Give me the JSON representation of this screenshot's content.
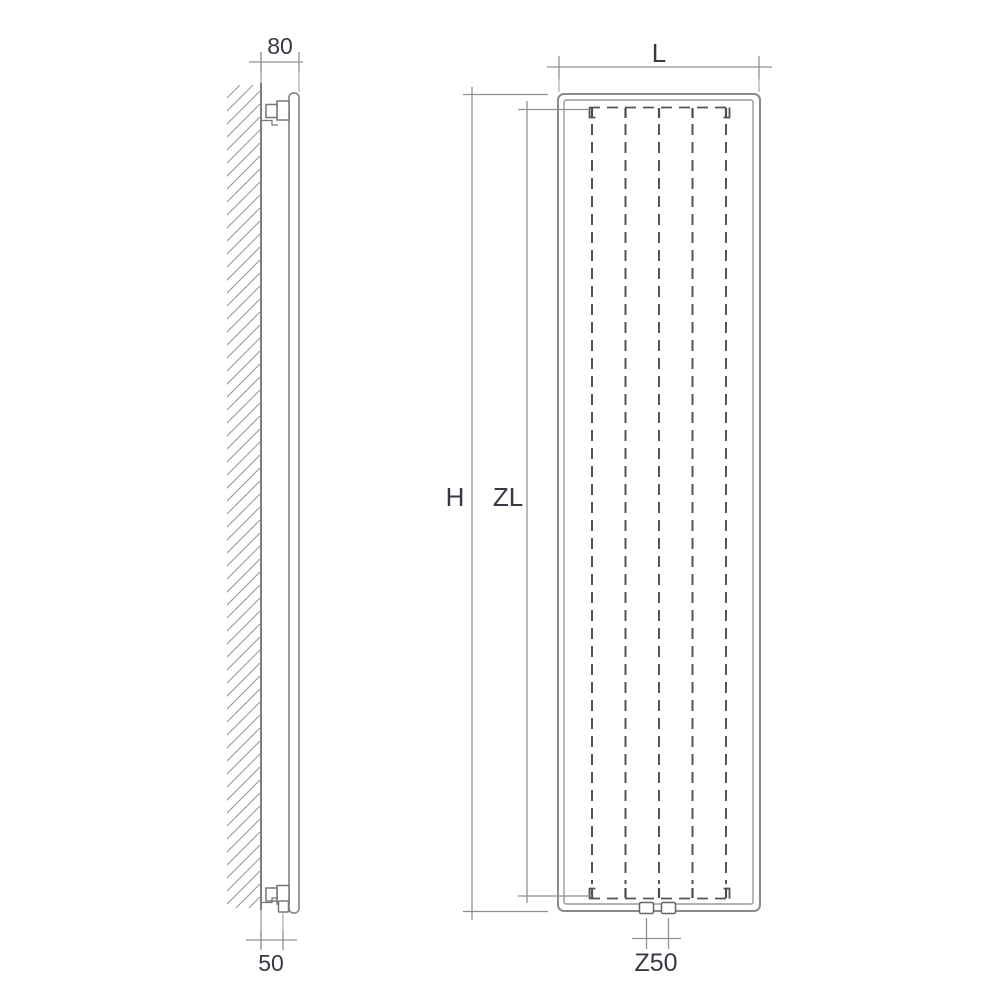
{
  "title": "Vertical panel radiator technical drawing (side view and front view)",
  "colors": {
    "background": "#ffffff",
    "object_line": "#8a8a8a",
    "detail_line": "#555555",
    "dimension_line": "#919191",
    "text": "#383844"
  },
  "side_view": {
    "depth_dimension": "80",
    "bottom_connection_dimension": "50"
  },
  "front_view": {
    "width_dimension": "L",
    "height_dimension": "H",
    "convector_length_dimension": "ZL",
    "connection_spacing_dimension": "Z50"
  }
}
